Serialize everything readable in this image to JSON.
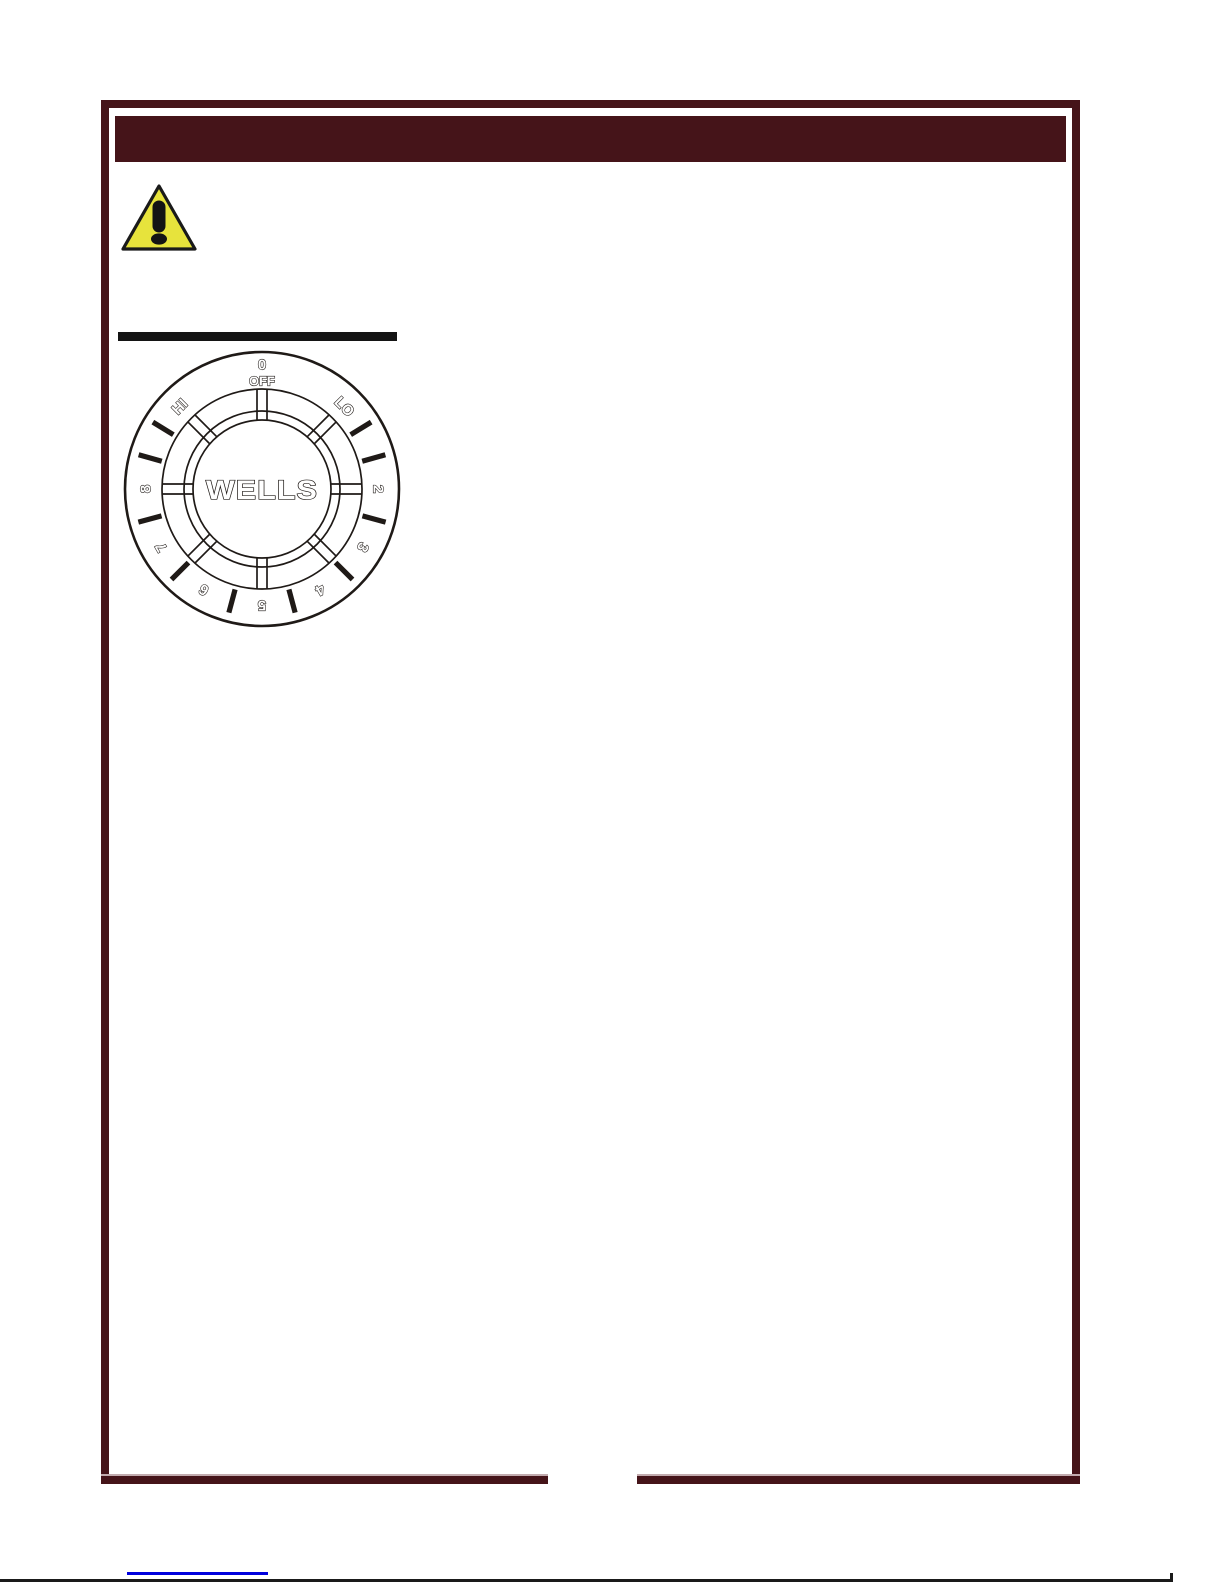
{
  "page": {
    "background": "#ffffff",
    "frame_color": "#451419",
    "header_bar_color": "#451419",
    "heading_rule_color": "#141414",
    "footer_divider_color": "#1a1a1a",
    "footer_link_color": "#0000dd"
  },
  "warning": {
    "triangle_fill": "#e7e33c",
    "triangle_border": "#1a1a1a",
    "exclamation_color": "#141414"
  },
  "dial": {
    "brand": "WELLS",
    "stroke_color": "#1f1a17",
    "label_fill": "#ffffff",
    "rings": {
      "outer_r": 137,
      "band_r": 100,
      "hub_outer_r": 78,
      "hub_inner_r": 69
    },
    "labels": [
      {
        "text": "0",
        "angle": 0,
        "r": 124,
        "size": 15
      },
      {
        "text": "OFF",
        "angle": 0,
        "r": 108,
        "size": 13
      },
      {
        "text": "LO",
        "angle": 45,
        "r": 116,
        "size": 15
      },
      {
        "text": "2",
        "angle": 90,
        "r": 116,
        "size": 15
      },
      {
        "text": "3",
        "angle": 120,
        "r": 116,
        "size": 15
      },
      {
        "text": "4",
        "angle": 150,
        "r": 116,
        "size": 15
      },
      {
        "text": "5",
        "angle": 180,
        "r": 116,
        "size": 15
      },
      {
        "text": "6",
        "angle": 210,
        "r": 116,
        "size": 15
      },
      {
        "text": "7",
        "angle": 240,
        "r": 116,
        "size": 15
      },
      {
        "text": "8",
        "angle": 270,
        "r": 116,
        "size": 15
      },
      {
        "text": "HI",
        "angle": 315,
        "r": 116,
        "size": 15
      }
    ],
    "tick_angles": [
      58.5,
      74.5,
      105,
      135,
      165,
      195,
      225,
      255,
      285.5,
      301.5
    ],
    "spoke_angles": [
      0,
      45,
      90,
      135,
      180,
      225,
      270,
      315
    ]
  }
}
